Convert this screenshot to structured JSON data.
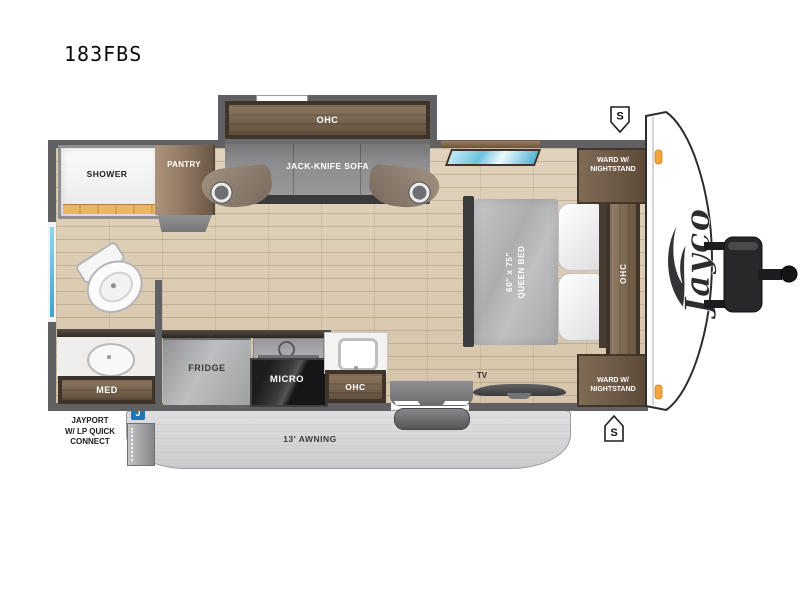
{
  "title": "183FBS",
  "brand": {
    "logo_text": "Jayco"
  },
  "floorplan": {
    "shower": "SHOWER",
    "pantry": "PANTRY",
    "slide_ohc": "OHC",
    "sofa": "JACK-KNIFE SOFA",
    "ward_top": "WARD W/\nNIGHTSTAND",
    "bed": "60\" x 75\"\nQUEEN BED",
    "bed_ohc": "OHC",
    "ward_bottom": "WARD W/\nNIGHTSTAND",
    "med": "MED",
    "fridge": "FRIDGE",
    "micro": "MICRO",
    "kitchen_ohc": "OHC",
    "tv": "TV"
  },
  "exterior": {
    "awning": "13' AWNING",
    "jayport": "JAYPORT\nW/ LP QUICK\nCONNECT",
    "jayport_badge": "J",
    "speaker_top": "S",
    "speaker_bottom": "S"
  },
  "colors": {
    "wall": "#616163",
    "wood_frame": "#3f342a",
    "wood": "#8d7761",
    "floor": "#dccbb2",
    "awning": "#d6d6d8",
    "window_blue": "#6ec6e4",
    "jayport_blue": "#1878b9",
    "marker_orange": "#f4a43c"
  }
}
